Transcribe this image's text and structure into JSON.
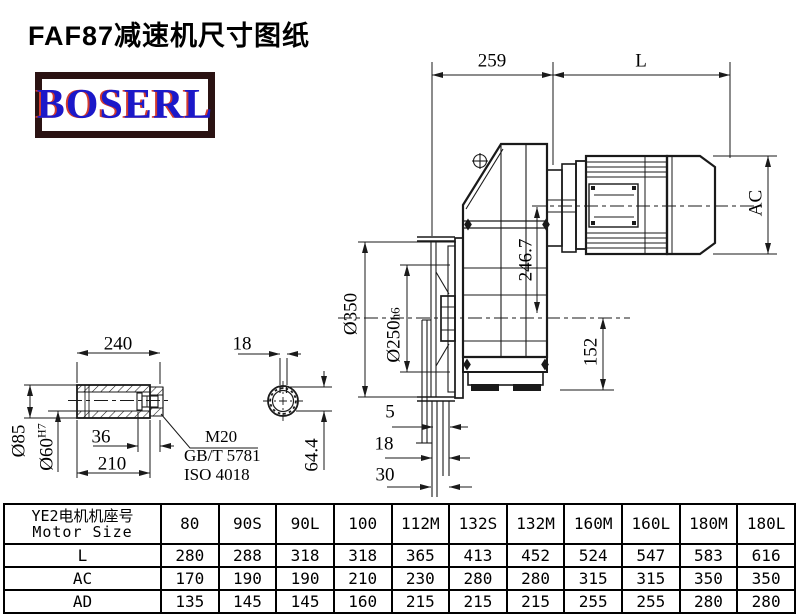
{
  "title": "FAF87减速机尺寸图纸",
  "logo": {
    "text": "BOSERL"
  },
  "drawing": {
    "dims": {
      "gearbox_length": "259",
      "motor_length": "L",
      "motor_diameter": "AC",
      "axis_height": "246.7",
      "flange_diameter": "Ø350",
      "spigot_diameter": "Ø250",
      "spigot_tolerance": "h6",
      "foot_height": "152",
      "tab_5": "5",
      "tab_18": "18",
      "tab_30": "30",
      "shaft_length": "240",
      "shaft_od": "Ø85",
      "bore_diameter": "Ø60",
      "bore_tolerance": "H7",
      "end_cap": "36",
      "shaft_inner_length": "210",
      "keyway_width": "18",
      "keyway_depth": "64.4"
    },
    "notes": {
      "thread": "M20",
      "standard1": "GB/T 5781",
      "standard2": "ISO 4018"
    }
  },
  "table": {
    "header": {
      "line1": "YE2电机机座号",
      "line2": "Motor Size"
    },
    "columns": [
      "80",
      "90S",
      "90L",
      "100",
      "112M",
      "132S",
      "132M",
      "160M",
      "160L",
      "180M",
      "180L"
    ],
    "rows": [
      {
        "label": "L",
        "values": [
          "280",
          "288",
          "318",
          "318",
          "365",
          "413",
          "452",
          "524",
          "547",
          "583",
          "616"
        ]
      },
      {
        "label": "AC",
        "values": [
          "170",
          "190",
          "190",
          "210",
          "230",
          "280",
          "280",
          "315",
          "315",
          "350",
          "350"
        ]
      },
      {
        "label": "AD",
        "values": [
          "135",
          "145",
          "145",
          "160",
          "215",
          "215",
          "215",
          "255",
          "255",
          "280",
          "280"
        ]
      }
    ]
  },
  "colors": {
    "line": "#1a1a1a",
    "logo_text": "#1b18c9",
    "logo_border": "#2b1313",
    "logo_fringe": "#d23b2e"
  }
}
